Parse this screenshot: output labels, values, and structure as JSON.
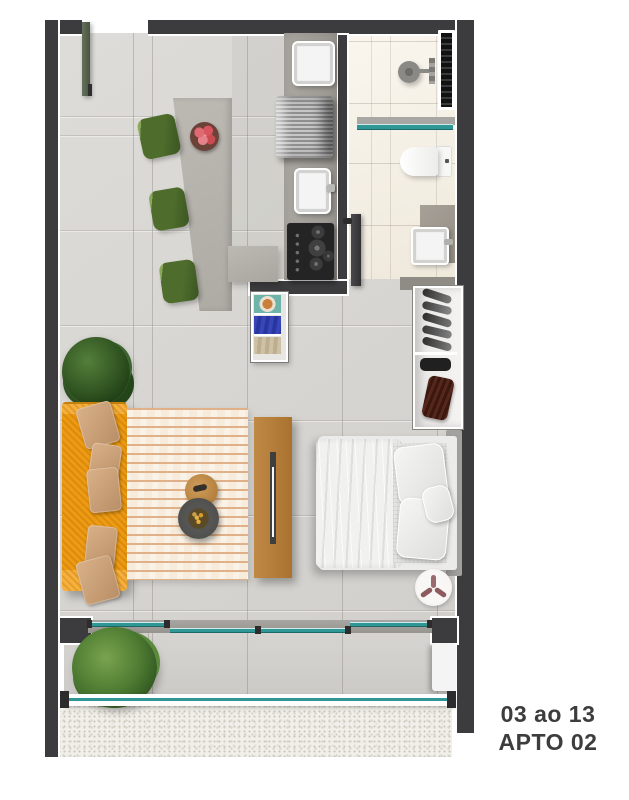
{
  "unit_label": {
    "line1": "03 ao 13",
    "line2": "APTO 02"
  },
  "colors": {
    "wall": "#3c3c3e",
    "trim": "#ffffff",
    "floor": "#d8d6d2",
    "floor-bath": "#f5f0e6",
    "floor-balcony": "#d0cecа",
    "counter": "#a3a09a",
    "island": "#b5b2ac",
    "glass": "#2f9795",
    "sofa": "#ee9b13",
    "pillow": "#c99d75",
    "rug-base": "#f7ecdc",
    "rug-stripe": "#e0b088",
    "wood": "#b5803e",
    "chair": "#4e6c2c",
    "table-dark": "#4a4a48",
    "bed": "#ebebe9",
    "gravel": "#f1efe9",
    "label": "#3d3d3d"
  }
}
